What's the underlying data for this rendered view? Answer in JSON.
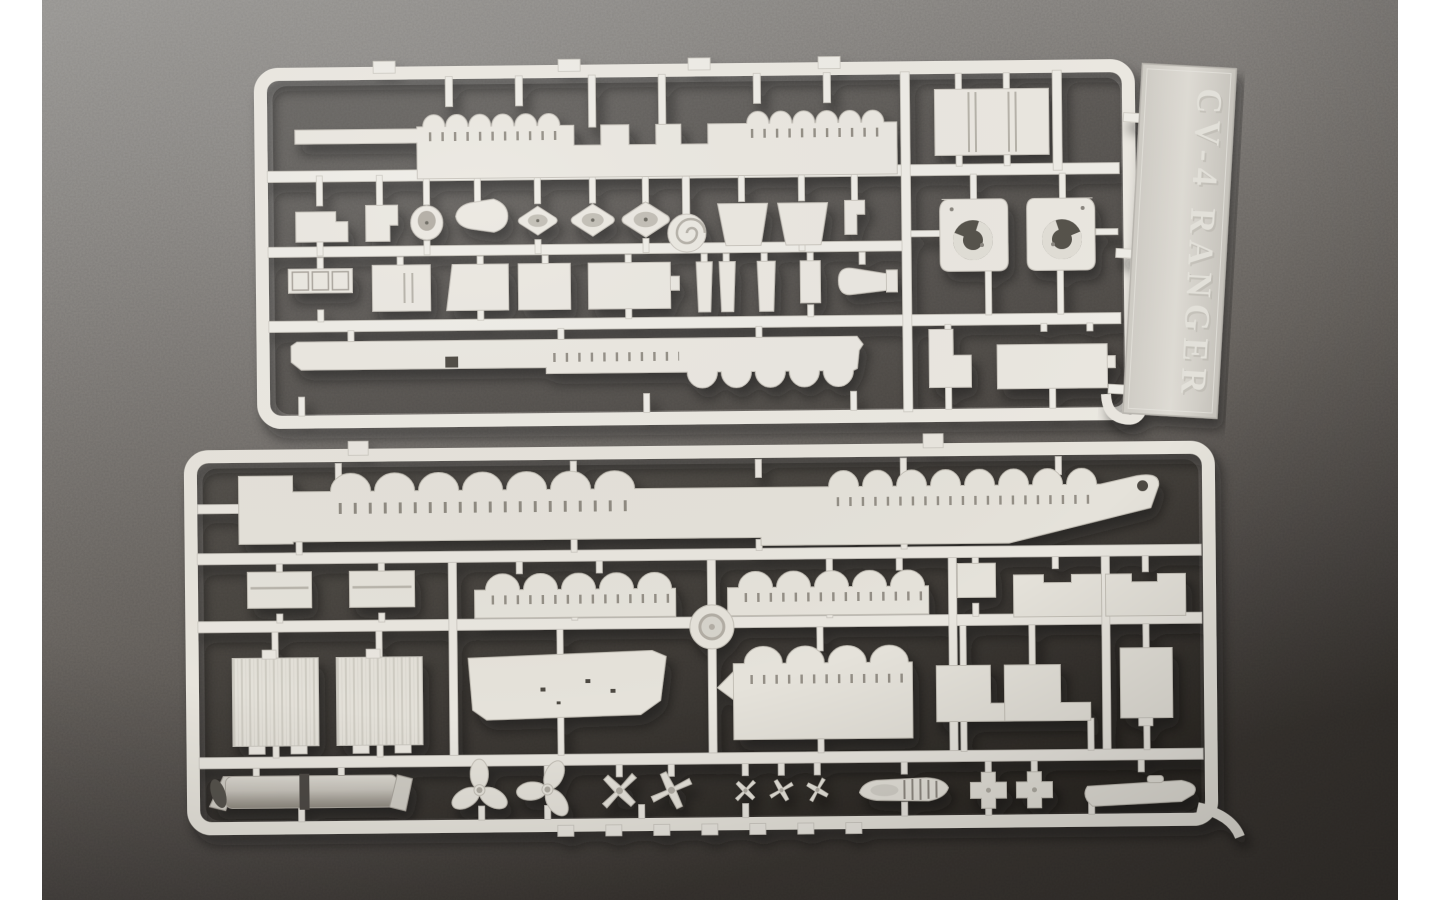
{
  "photo": {
    "nameplate_text": "CV-4 RANGER",
    "colors": {
      "background_top": "#969491",
      "background_bottom": "#37332f",
      "plastic_upper_sprue": "#ebe8e1",
      "plastic_lower_sprue": "#e5e2da",
      "photo_border": "#ffffff"
    }
  }
}
